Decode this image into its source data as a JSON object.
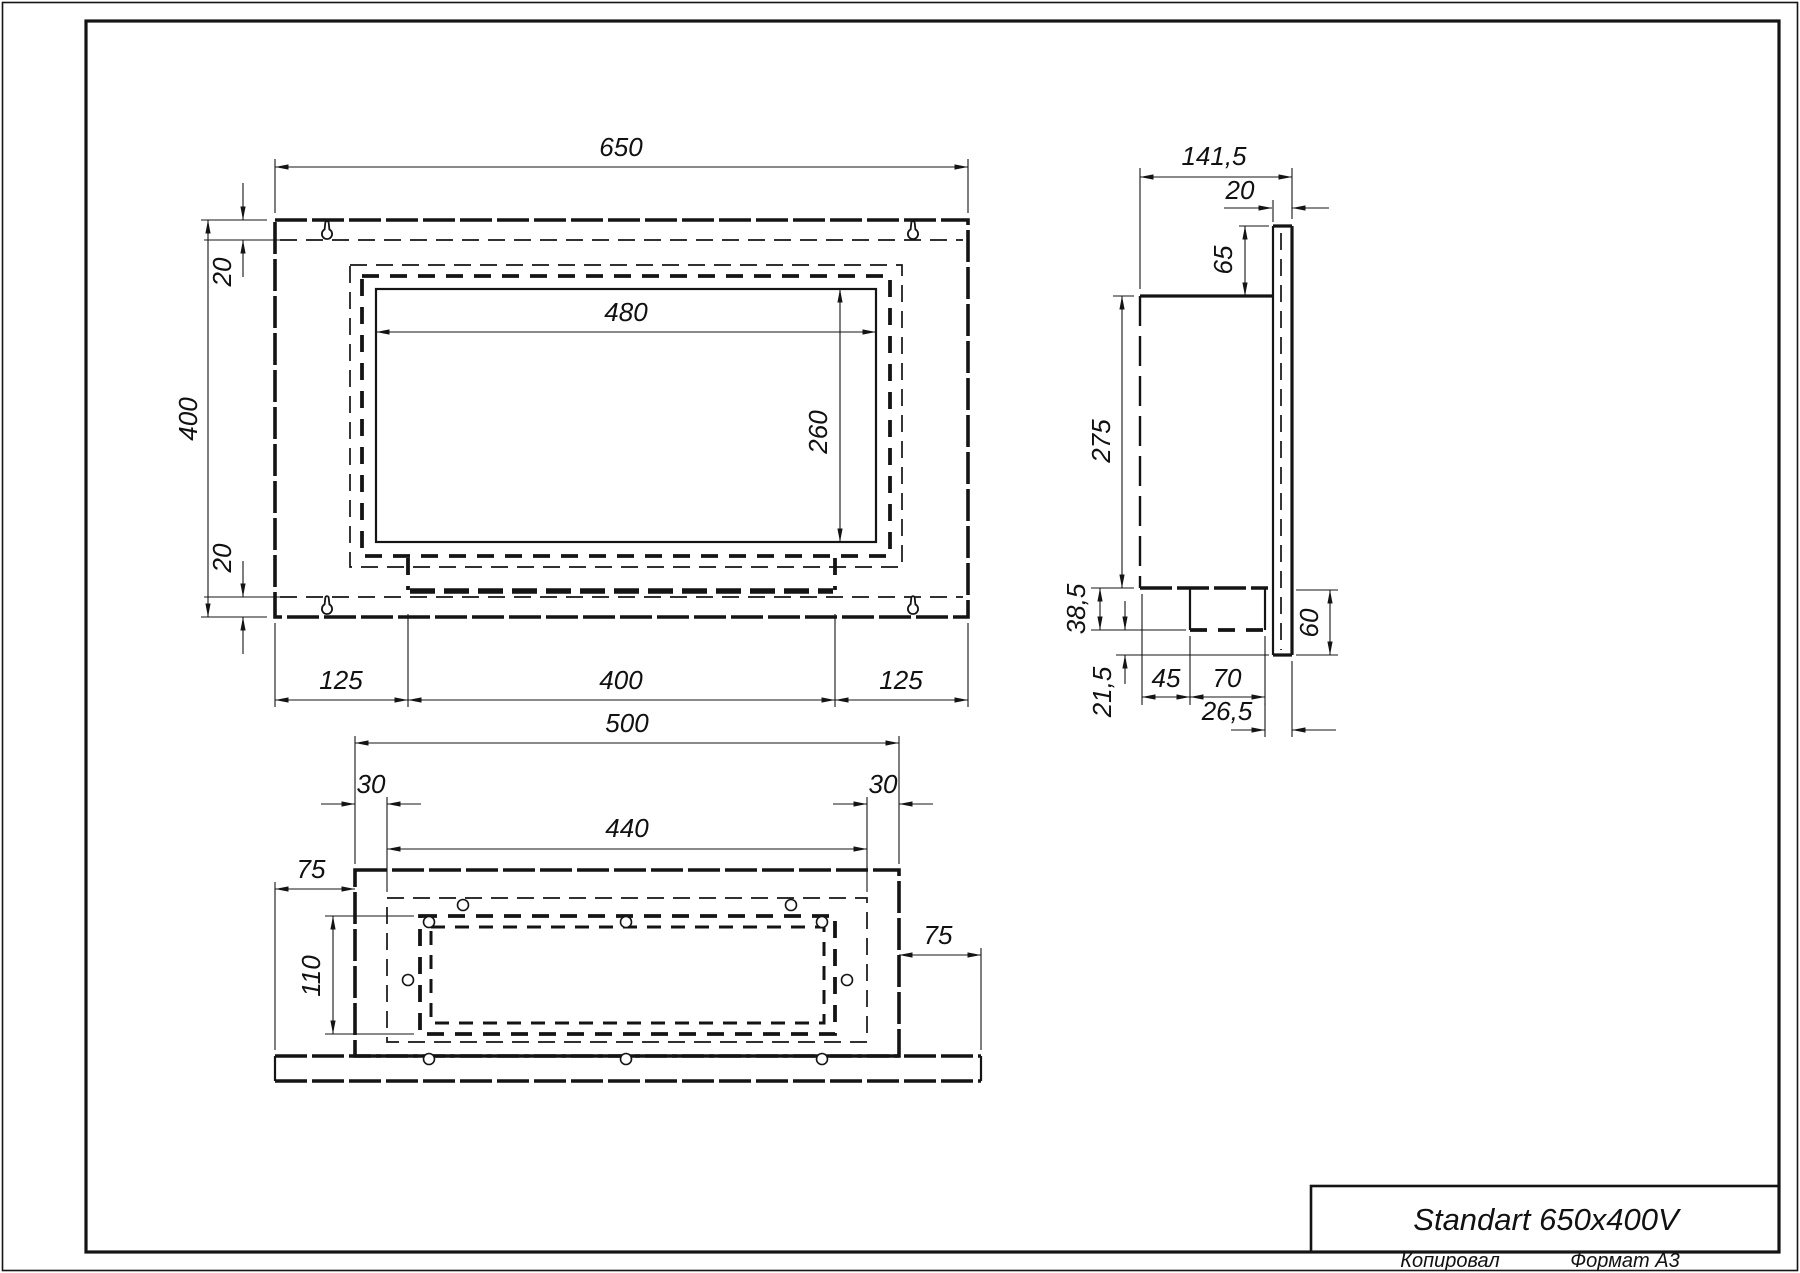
{
  "page": {
    "title": "Standart 650x400V",
    "footer_left": "Копировал",
    "footer_right": "Формат А3",
    "colors": {
      "ink": "#141414",
      "paper": "#ffffff"
    }
  },
  "front": {
    "d650": "650",
    "d400": "400",
    "d20_top": "20",
    "d20_bottom": "20",
    "d480": "480",
    "d260": "260",
    "d125_left": "125",
    "d400_bottom": "400",
    "d125_right": "125"
  },
  "side": {
    "d141_5": "141,5",
    "d20": "20",
    "d65": "65",
    "d275": "275",
    "d38_5": "38,5",
    "d21_5": "21,5",
    "d45": "45",
    "d70": "70",
    "d26_5": "26,5",
    "d60": "60"
  },
  "bottom": {
    "d500": "500",
    "d30_left": "30",
    "d440": "440",
    "d30_right": "30",
    "d75_left": "75",
    "d110": "110",
    "d75_right": "75"
  }
}
